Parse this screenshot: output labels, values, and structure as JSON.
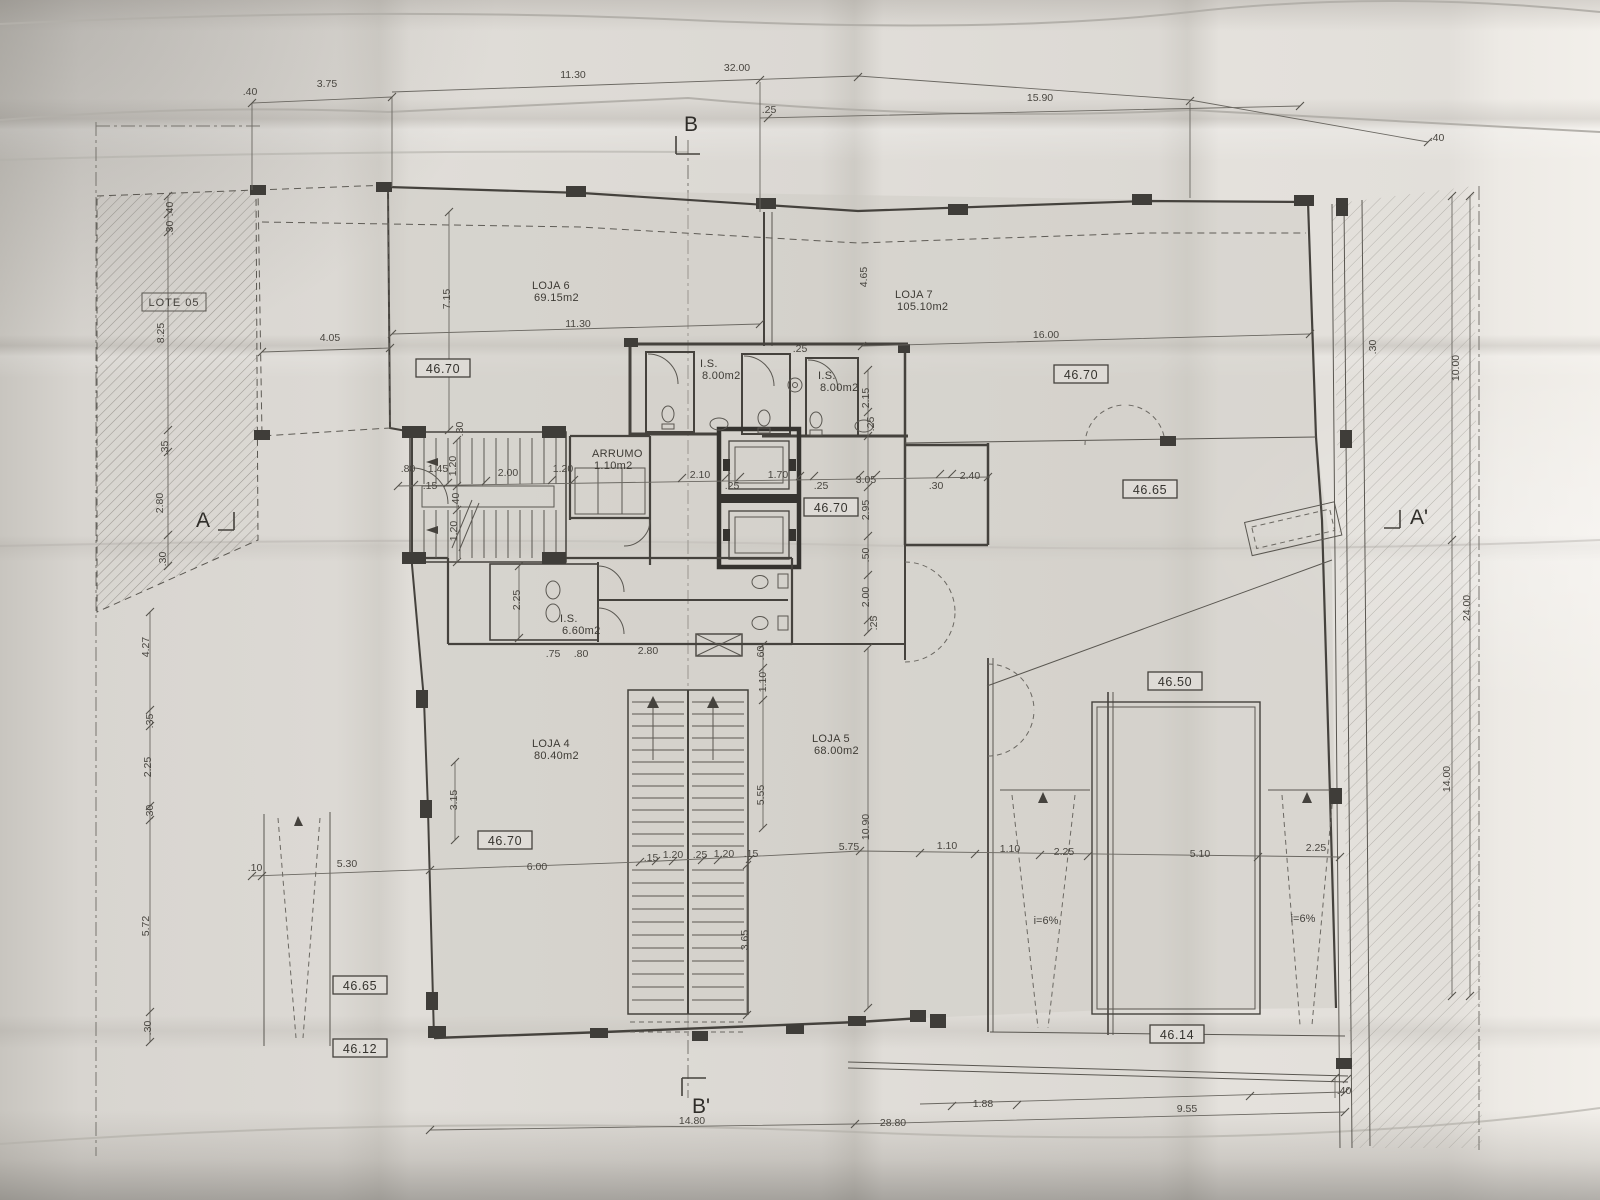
{
  "plan": {
    "lot_label": "LOTE 05",
    "section_markers": [
      {
        "id": "B",
        "x": 684,
        "y": 131
      },
      {
        "id": "B'",
        "x": 692,
        "y": 1113
      },
      {
        "id": "A",
        "x": 196,
        "y": 527
      },
      {
        "id": "A'",
        "x": 1410,
        "y": 524
      }
    ],
    "rooms": [
      {
        "name": "LOJA 6",
        "area": "69.15m2",
        "x": 532,
        "y": 289
      },
      {
        "name": "LOJA 7",
        "area": "105.10m2",
        "x": 895,
        "y": 298
      },
      {
        "name": "LOJA 4",
        "area": "80.40m2",
        "x": 532,
        "y": 747
      },
      {
        "name": "LOJA 5",
        "area": "68.00m2",
        "x": 812,
        "y": 742
      },
      {
        "name": "I.S.",
        "area": "8.00m2",
        "x": 700,
        "y": 367
      },
      {
        "name": "I.S.",
        "area": "8.00m2",
        "x": 818,
        "y": 379
      },
      {
        "name": "I.S.",
        "area": "6.60m2",
        "x": 560,
        "y": 622
      },
      {
        "name": "ARRUMO",
        "area": "1.10m2",
        "x": 592,
        "y": 457
      }
    ],
    "elevation_markers": [
      {
        "value": "46.70",
        "x": 443,
        "y": 371
      },
      {
        "value": "46.70",
        "x": 1081,
        "y": 377
      },
      {
        "value": "46.70",
        "x": 831,
        "y": 510
      },
      {
        "value": "46.65",
        "x": 1150,
        "y": 492
      },
      {
        "value": "46.50",
        "x": 1175,
        "y": 684
      },
      {
        "value": "46.70",
        "x": 505,
        "y": 843
      },
      {
        "value": "46.65",
        "x": 360,
        "y": 988
      },
      {
        "value": "46.12",
        "x": 360,
        "y": 1051
      },
      {
        "value": "46.14",
        "x": 1177,
        "y": 1037
      }
    ],
    "ramp_labels": [
      {
        "text": "i=6%",
        "x": 1046,
        "y": 924
      },
      {
        "text": "i=6%",
        "x": 1303,
        "y": 922
      }
    ],
    "dimensions": [
      {
        "t": ".40",
        "x": 250,
        "y": 95
      },
      {
        "t": "3.75",
        "x": 327,
        "y": 87
      },
      {
        "t": "11.30",
        "x": 573,
        "y": 78
      },
      {
        "t": "32.00",
        "x": 737,
        "y": 71
      },
      {
        "t": ".25",
        "x": 769,
        "y": 113
      },
      {
        "t": "15.90",
        "x": 1040,
        "y": 101
      },
      {
        "t": ".40",
        "x": 1437,
        "y": 141
      },
      {
        "t": ".40",
        "x": 173,
        "y": 209,
        "r": -90
      },
      {
        "t": ".30",
        "x": 173,
        "y": 228,
        "r": -90
      },
      {
        "t": "8.25",
        "x": 164,
        "y": 333,
        "r": -90
      },
      {
        "t": ".35",
        "x": 168,
        "y": 448,
        "r": -90
      },
      {
        "t": "2.80",
        "x": 163,
        "y": 503,
        "r": -90
      },
      {
        "t": ".30",
        "x": 166,
        "y": 559,
        "r": -90
      },
      {
        "t": "4.27",
        "x": 149,
        "y": 647,
        "r": -90
      },
      {
        "t": ".35",
        "x": 153,
        "y": 721,
        "r": -90
      },
      {
        "t": "2.25",
        "x": 151,
        "y": 767,
        "r": -90
      },
      {
        "t": ".30",
        "x": 153,
        "y": 812,
        "r": -90
      },
      {
        "t": "5.72",
        "x": 149,
        "y": 926,
        "r": -90
      },
      {
        "t": ".30",
        "x": 151,
        "y": 1028,
        "r": -90
      },
      {
        "t": "4.05",
        "x": 330,
        "y": 341
      },
      {
        "t": "7.15",
        "x": 450,
        "y": 299,
        "r": -90
      },
      {
        "t": "11.30",
        "x": 578,
        "y": 327
      },
      {
        "t": "16.00",
        "x": 1046,
        "y": 338
      },
      {
        "t": "4.65",
        "x": 867,
        "y": 277,
        "r": -90
      },
      {
        "t": ".25",
        "x": 800,
        "y": 352
      },
      {
        "t": "2.15",
        "x": 869,
        "y": 398,
        "r": -90
      },
      {
        "t": ".25",
        "x": 874,
        "y": 424,
        "r": -90
      },
      {
        "t": ".30",
        "x": 463,
        "y": 429,
        "r": -90
      },
      {
        "t": ".80",
        "x": 408,
        "y": 472
      },
      {
        "t": "1.45",
        "x": 438,
        "y": 472
      },
      {
        "t": ".15",
        "x": 430,
        "y": 489
      },
      {
        "t": "1.20",
        "x": 456,
        "y": 466,
        "r": -90
      },
      {
        "t": "2.00",
        "x": 508,
        "y": 476
      },
      {
        "t": "1.20",
        "x": 563,
        "y": 472
      },
      {
        "t": "2.10",
        "x": 700,
        "y": 478
      },
      {
        "t": ".25",
        "x": 732,
        "y": 489
      },
      {
        "t": "1.70",
        "x": 778,
        "y": 478
      },
      {
        "t": ".25",
        "x": 821,
        "y": 489
      },
      {
        "t": "3.05",
        "x": 866,
        "y": 483
      },
      {
        "t": ".30",
        "x": 936,
        "y": 489
      },
      {
        "t": "2.40",
        "x": 970,
        "y": 479
      },
      {
        "t": ".40",
        "x": 459,
        "y": 500,
        "r": -90
      },
      {
        "t": "1.20",
        "x": 457,
        "y": 531,
        "r": -90
      },
      {
        "t": "2.95",
        "x": 869,
        "y": 510,
        "r": -90
      },
      {
        "t": ".50",
        "x": 869,
        "y": 555,
        "r": -90
      },
      {
        "t": "2.00",
        "x": 869,
        "y": 597,
        "r": -90
      },
      {
        "t": ".25",
        "x": 877,
        "y": 623,
        "r": -90
      },
      {
        "t": "2.25",
        "x": 520,
        "y": 600,
        "r": -90
      },
      {
        "t": ".75",
        "x": 553,
        "y": 657
      },
      {
        "t": ".80",
        "x": 581,
        "y": 657
      },
      {
        "t": "2.80",
        "x": 648,
        "y": 654
      },
      {
        "t": ".60",
        "x": 764,
        "y": 653,
        "r": -90
      },
      {
        "t": "1.10",
        "x": 766,
        "y": 682,
        "r": -90
      },
      {
        "t": "5.55",
        "x": 764,
        "y": 795,
        "r": -90
      },
      {
        "t": "3.65",
        "x": 748,
        "y": 940,
        "r": -90
      },
      {
        "t": "10.90",
        "x": 869,
        "y": 827,
        "r": -90
      },
      {
        "t": "3.15",
        "x": 457,
        "y": 800,
        "r": -90
      },
      {
        "t": ".10",
        "x": 255,
        "y": 871
      },
      {
        "t": "5.30",
        "x": 347,
        "y": 867
      },
      {
        "t": "6.00",
        "x": 537,
        "y": 870
      },
      {
        "t": ".15",
        "x": 651,
        "y": 861
      },
      {
        "t": "1.20",
        "x": 673,
        "y": 858
      },
      {
        "t": ".25",
        "x": 700,
        "y": 858
      },
      {
        "t": "1.20",
        "x": 724,
        "y": 857
      },
      {
        "t": ".15",
        "x": 751,
        "y": 857
      },
      {
        "t": "5.75",
        "x": 849,
        "y": 850
      },
      {
        "t": "1.10",
        "x": 947,
        "y": 849
      },
      {
        "t": "1.10",
        "x": 1010,
        "y": 852
      },
      {
        "t": "2.25",
        "x": 1064,
        "y": 855
      },
      {
        "t": "5.10",
        "x": 1200,
        "y": 857
      },
      {
        "t": "2.25",
        "x": 1316,
        "y": 851
      },
      {
        "t": "14.80",
        "x": 692,
        "y": 1124
      },
      {
        "t": "28.80",
        "x": 893,
        "y": 1126
      },
      {
        "t": "1.88",
        "x": 983,
        "y": 1107
      },
      {
        "t": "9.55",
        "x": 1187,
        "y": 1112
      },
      {
        "t": ".40",
        "x": 1344,
        "y": 1094
      },
      {
        "t": "10.00",
        "x": 1459,
        "y": 368,
        "r": -90
      },
      {
        "t": "24.00",
        "x": 1470,
        "y": 608,
        "r": -90
      },
      {
        "t": "14.00",
        "x": 1450,
        "y": 779,
        "r": -90
      },
      {
        "t": ".30",
        "x": 1376,
        "y": 347,
        "r": -90
      }
    ]
  }
}
